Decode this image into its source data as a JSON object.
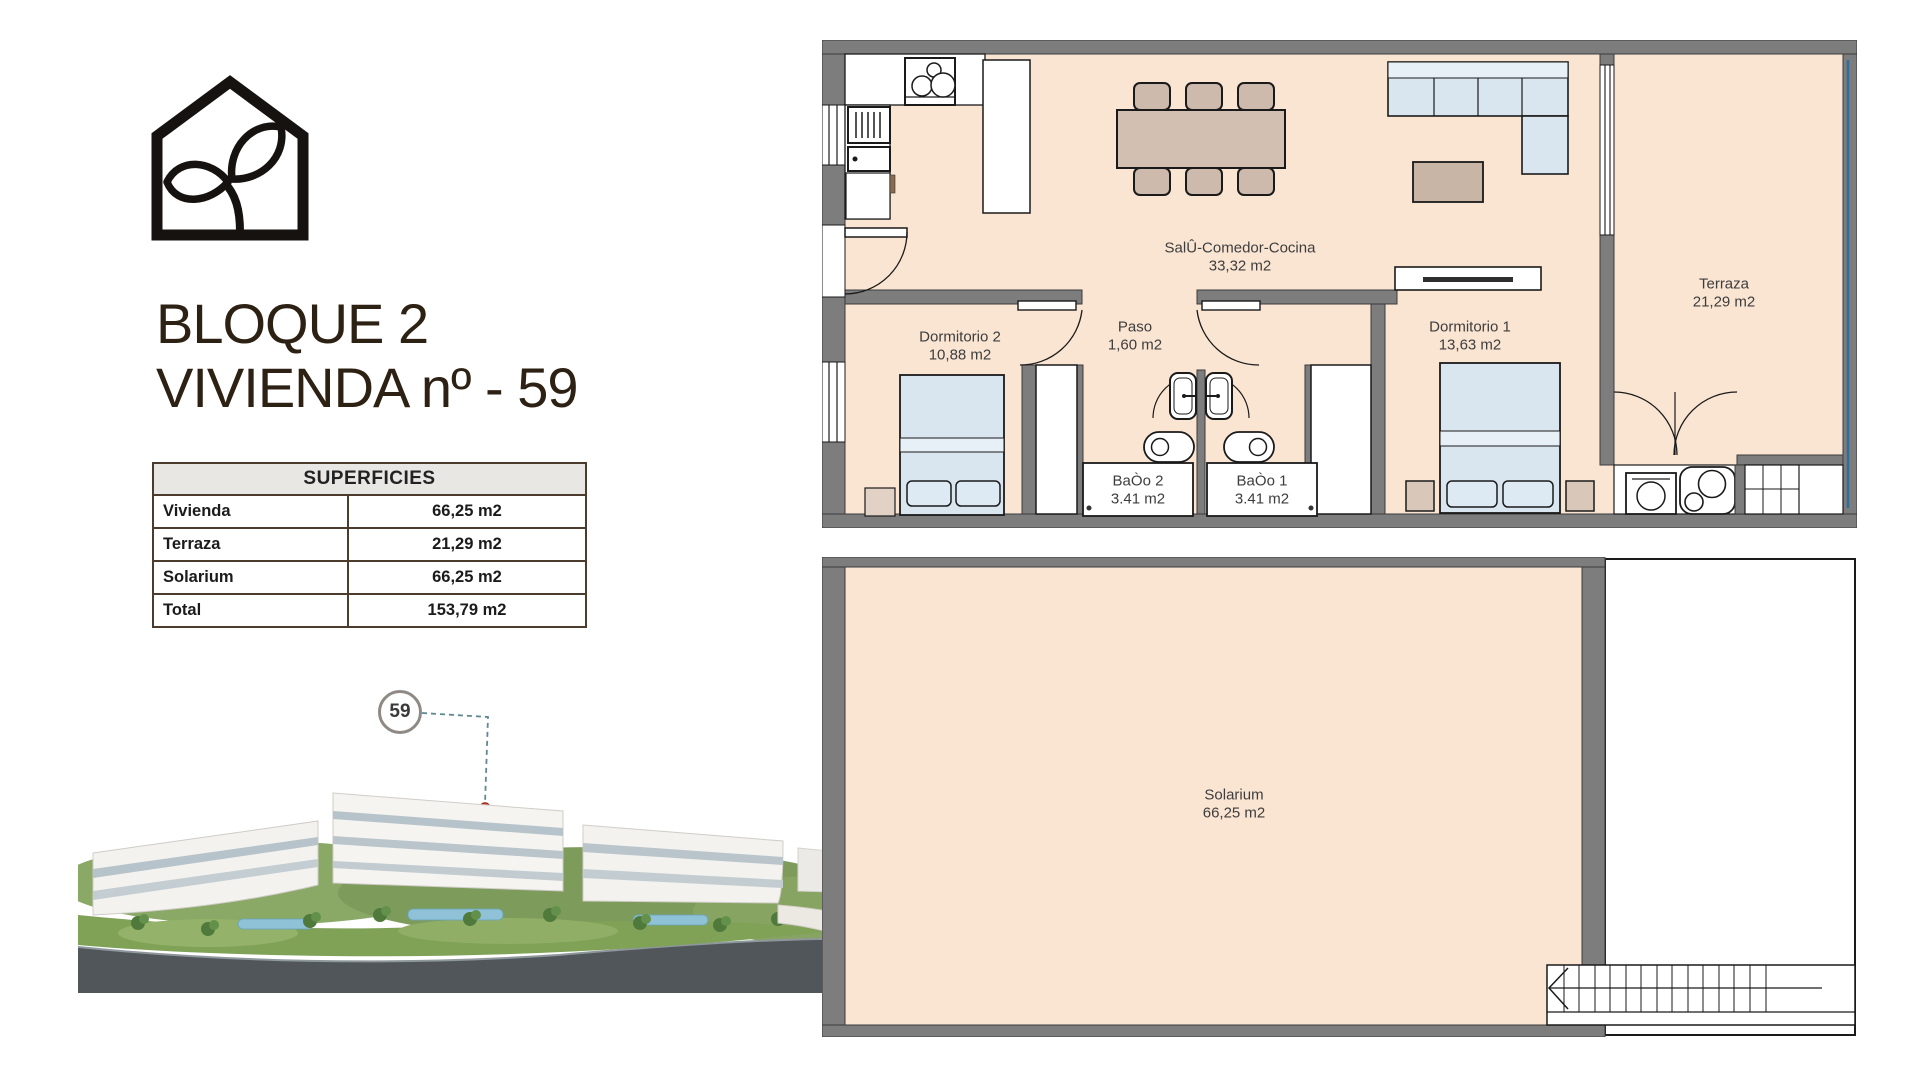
{
  "title": {
    "line1": "BLOQUE 2",
    "line2": "VIVIENDA nº - 59"
  },
  "superficies_table": {
    "header": "SUPERFICIES",
    "rows": [
      {
        "label": "Vivienda",
        "value": "66,25 m2"
      },
      {
        "label": "Terraza",
        "value": "21,29 m2"
      },
      {
        "label": "Solarium",
        "value": "66,25 m2"
      },
      {
        "label": "Total",
        "value": "153,79 m2"
      }
    ]
  },
  "unit_badge": {
    "number": "59"
  },
  "floor_plan": {
    "salon": {
      "name": "SalÛ-Comedor-Cocina",
      "area": "33,32 m2"
    },
    "paso": {
      "name": "Paso",
      "area": "1,60 m2"
    },
    "dormitorio2": {
      "name": "Dormitorio 2",
      "area": "10,88 m2"
    },
    "dormitorio1": {
      "name": "Dormitorio 1",
      "area": "13,63 m2"
    },
    "bano2": {
      "name": "BaÒo 2",
      "area": "3.41 m2"
    },
    "bano1": {
      "name": "BaÒo 1",
      "area": "3.41 m2"
    },
    "terraza": {
      "name": "Terraza",
      "area": "21,29 m2"
    }
  },
  "roof_plan": {
    "solarium": {
      "name": "Solarium",
      "area": "66,25 m2"
    }
  },
  "colors": {
    "floor_peach": "#fae5d3",
    "wall_gray": "#7d7d7d",
    "furniture_blue": "#d9e6f0",
    "furniture_tan": "#cdbaac",
    "railing_blue": "#2e6d9c",
    "marker_red": "#d23c2c",
    "title_brown": "#2d2114"
  }
}
